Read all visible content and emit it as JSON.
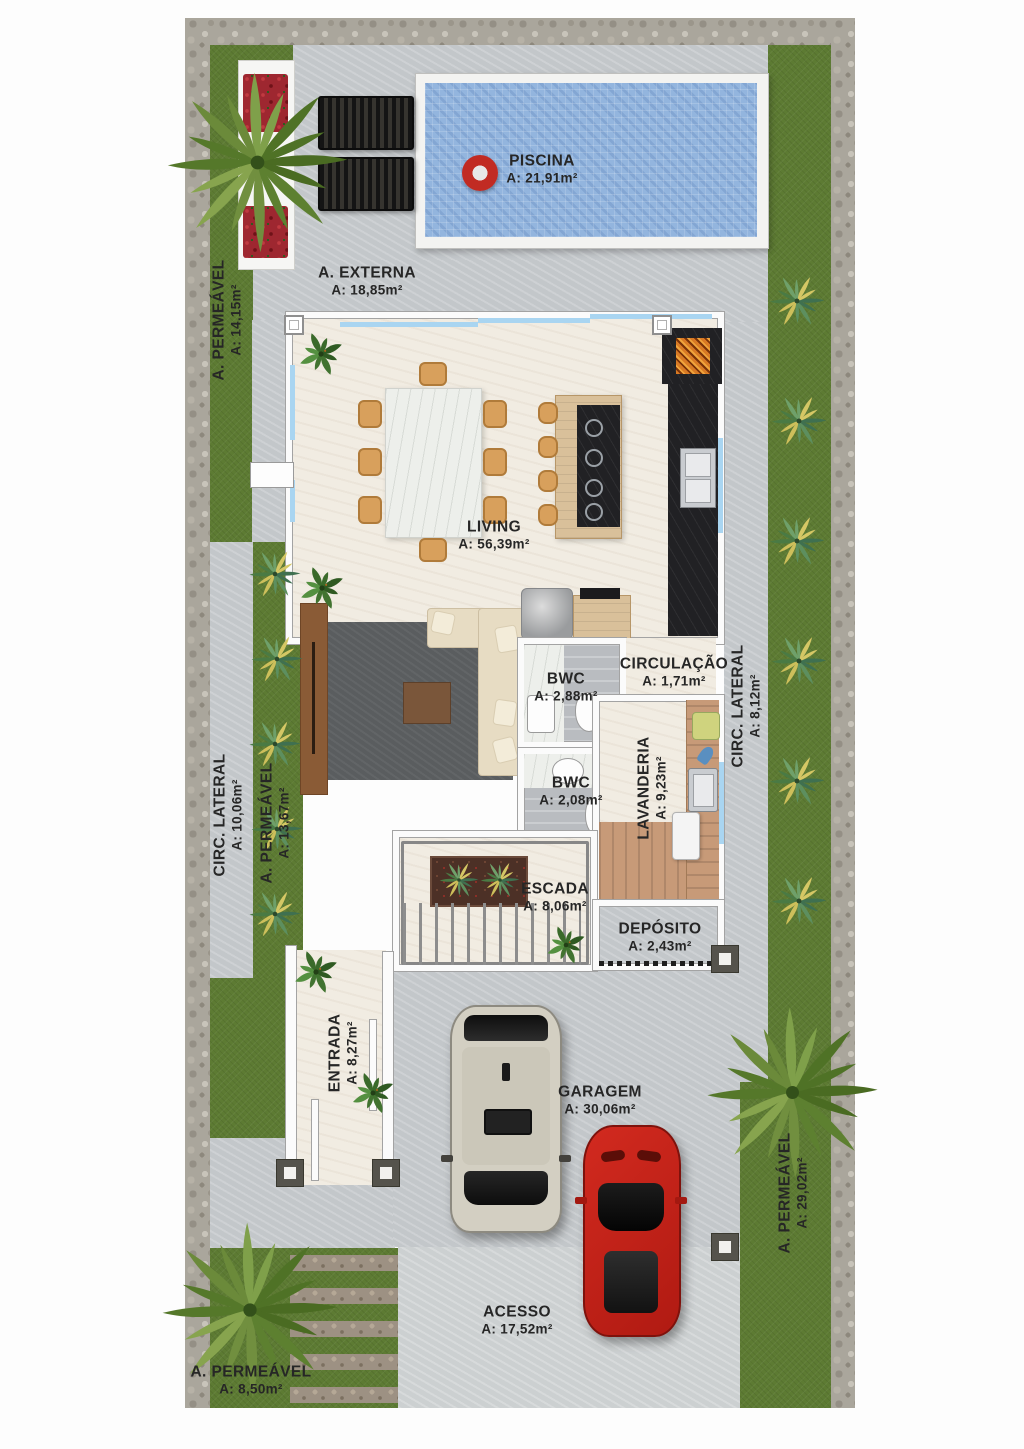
{
  "rooms": {
    "piscina": {
      "name": "PISCINA",
      "area": "A: 21,91m²"
    },
    "a_externa": {
      "name": "A. EXTERNA",
      "area": "A: 18,85m²"
    },
    "permeavel_top_left": {
      "name": "A. PERMEÁVEL",
      "area": "A: 14,15m²"
    },
    "living": {
      "name": "LIVING",
      "area": "A: 56,39m²"
    },
    "bwc1": {
      "name": "BWC",
      "area": "A: 2,88m²"
    },
    "circulacao": {
      "name": "CIRCULAÇÃO",
      "area": "A: 1,71m²"
    },
    "circ_lateral_right": {
      "name": "CIRC. LATERAL",
      "area": "A: 8,12m²"
    },
    "bwc2": {
      "name": "BWC",
      "area": "A: 2,08m²"
    },
    "lavanderia": {
      "name": "LAVANDERIA",
      "area": "A: 9,23m²"
    },
    "circ_lateral_left": {
      "name": "CIRC. LATERAL",
      "area": "A: 10,06m²"
    },
    "permeavel_left": {
      "name": "A. PERMEÁVEL",
      "area": "A: 13,67m²"
    },
    "escada": {
      "name": "ESCADA",
      "area": "A: 8,06m²"
    },
    "deposito": {
      "name": "DEPÓSITO",
      "area": "A: 2,43m²"
    },
    "entrada": {
      "name": "ENTRADA",
      "area": "A: 8,27m²"
    },
    "garagem": {
      "name": "GARAGEM",
      "area": "A: 30,06m²"
    },
    "permeavel_right": {
      "name": "A. PERMEÁVEL",
      "area": "A: 29,02m²"
    },
    "acesso": {
      "name": "ACESSO",
      "area": "A: 17,52m²"
    },
    "permeavel_bottom_left": {
      "name": "A. PERMEÁVEL",
      "area": "A: 8,50m²"
    }
  },
  "colors": {
    "grass": "#5d7b33",
    "stone_border": "#aaa69c",
    "concrete": "#c3c7ca",
    "access_concrete": "#ccd0d1",
    "pool_water": "#93b5de",
    "pool_rim": "#f3f3f1",
    "house_floor": "#f1ece2",
    "wall": "#fbfbfb",
    "black_counter": "#212124",
    "wood": "#c79a78",
    "island_wood": "#d9c09a",
    "rug": "#5a5d5f",
    "sofa": "#e7dcc3",
    "tv_panel": "#8a5b36",
    "car_red": "#c6241b",
    "suv_beige": "#d3cfc2",
    "label_text": "#262626",
    "glass": "#a9d5f1"
  }
}
